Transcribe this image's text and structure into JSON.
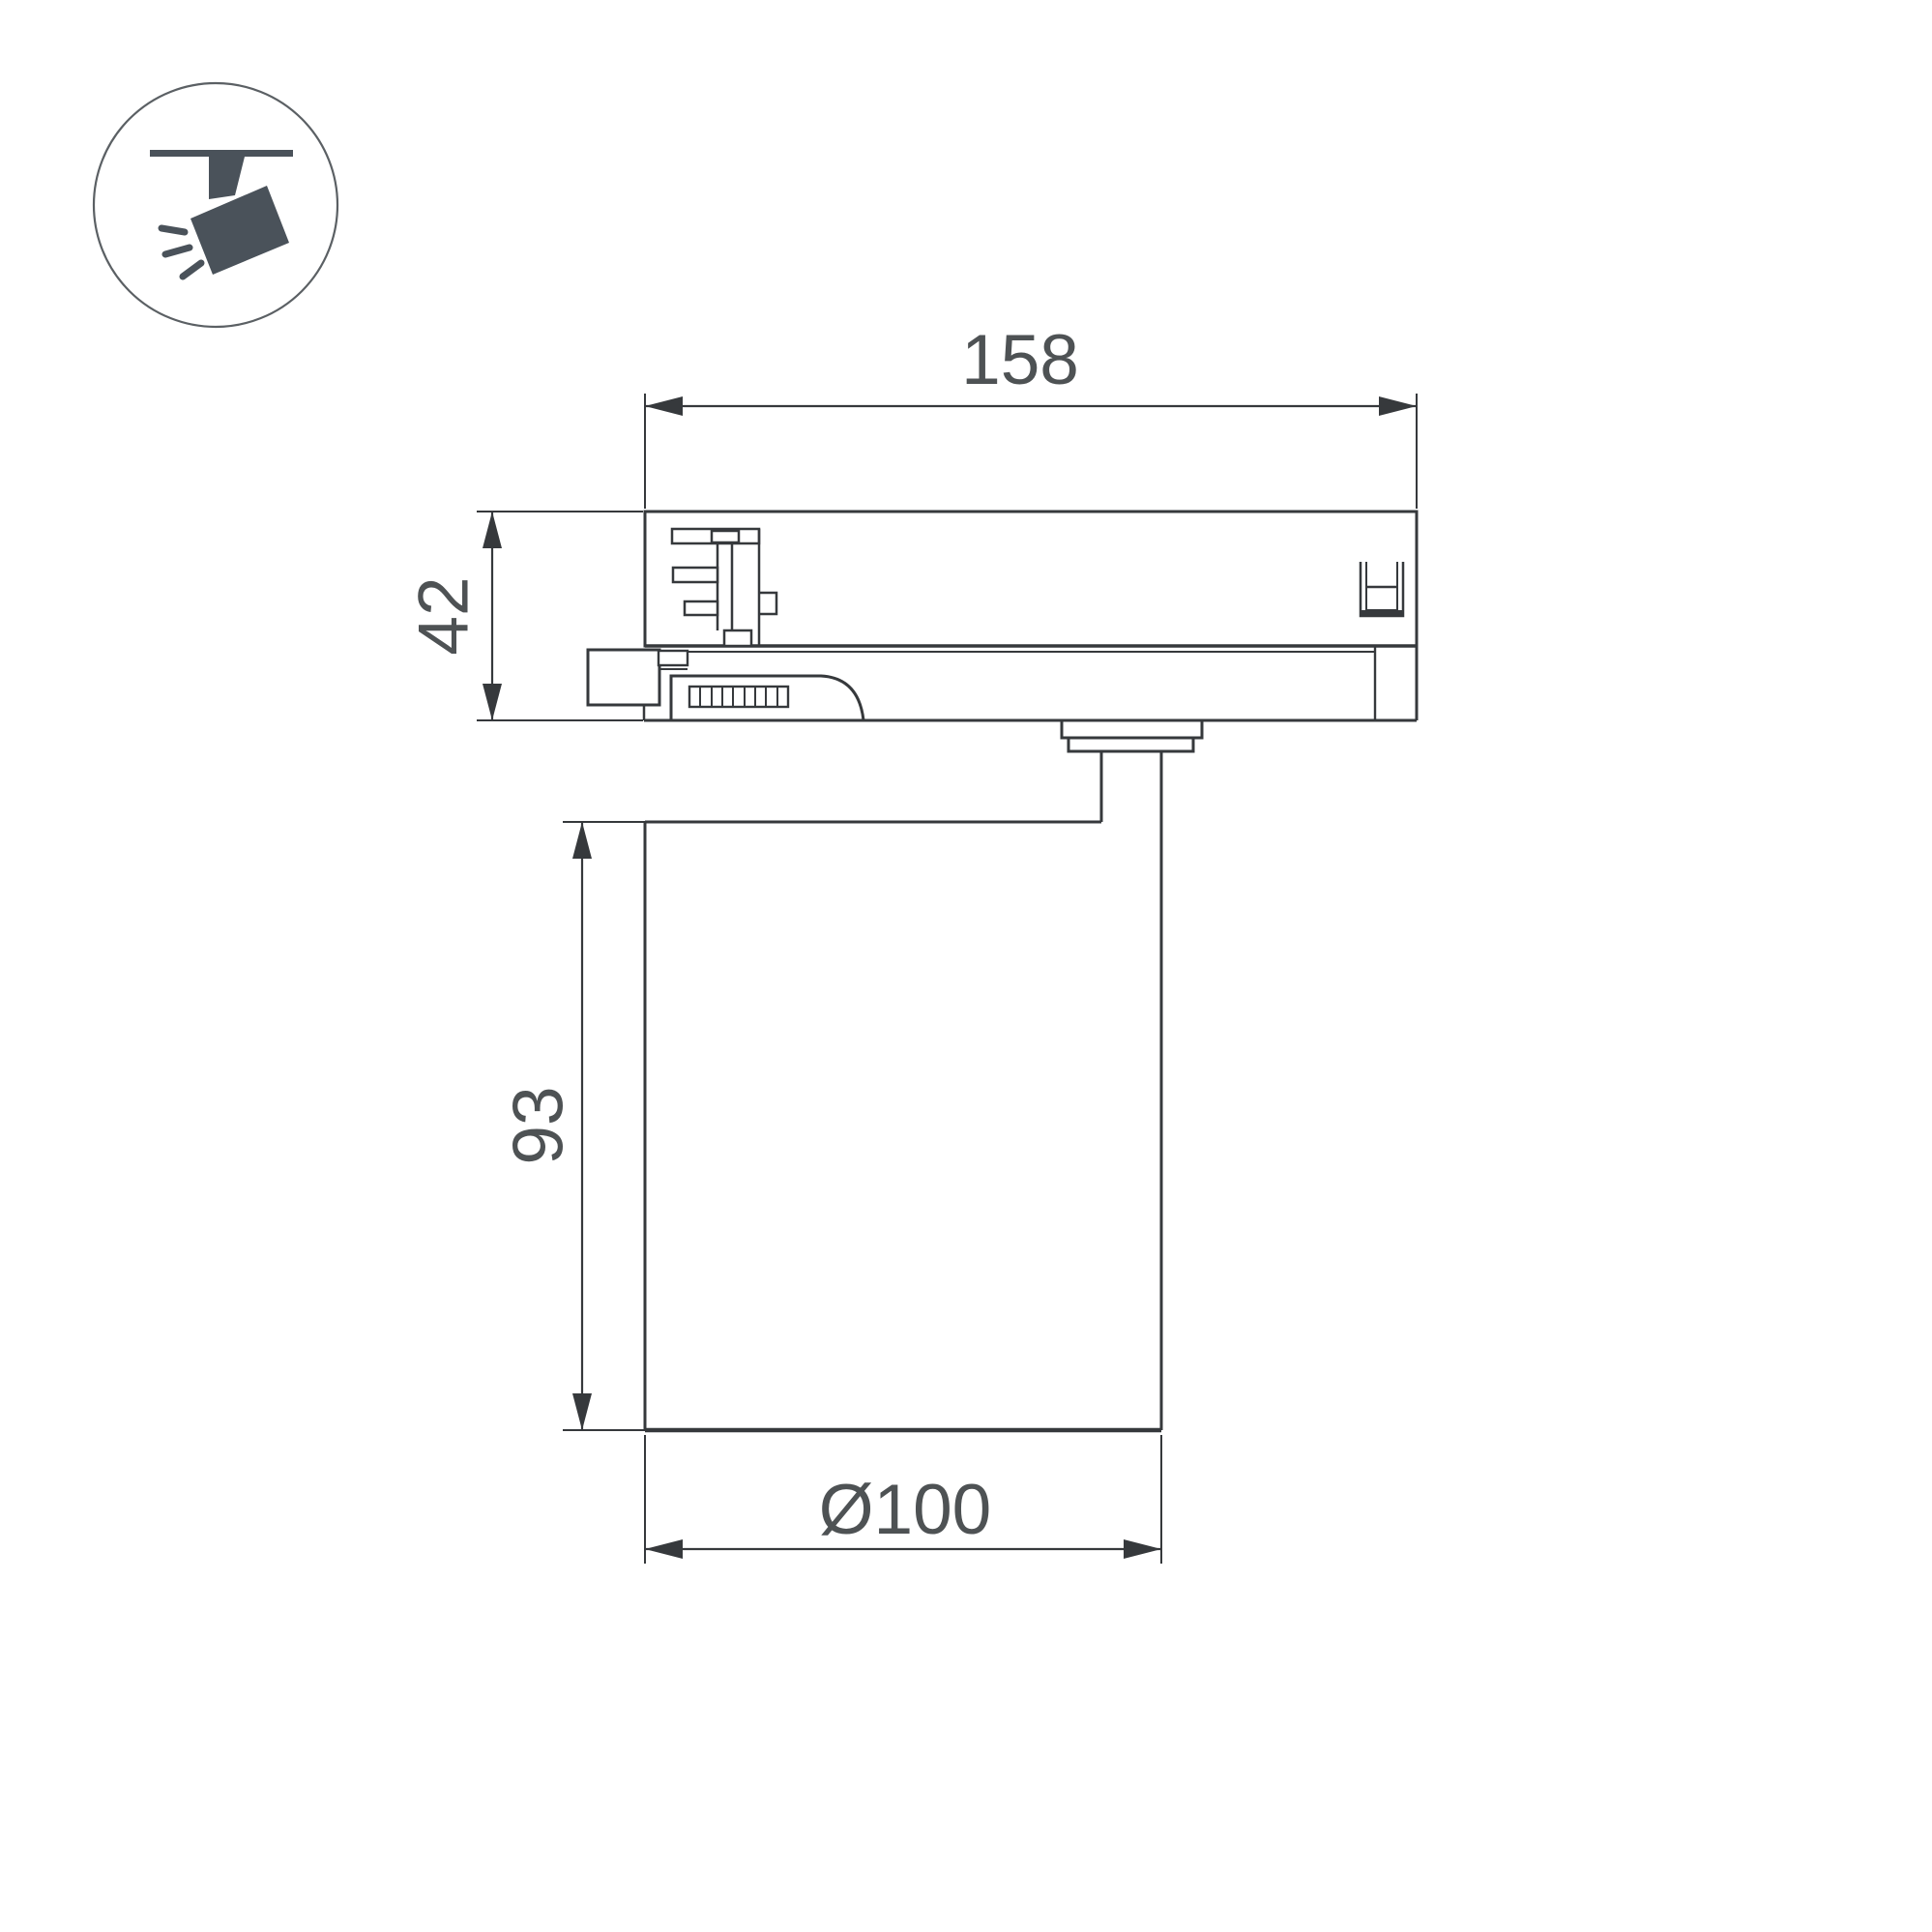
{
  "icon": {
    "name": "track-spotlight-icon"
  },
  "dimensions": {
    "track_adapter_width": "158",
    "track_adapter_height": "42",
    "body_height": "93",
    "body_diameter": "Ø100"
  },
  "colors": {
    "background": "#ffffff",
    "line": "#36393c",
    "dimension_text": "#4e5254",
    "icon": "#4a525a"
  }
}
